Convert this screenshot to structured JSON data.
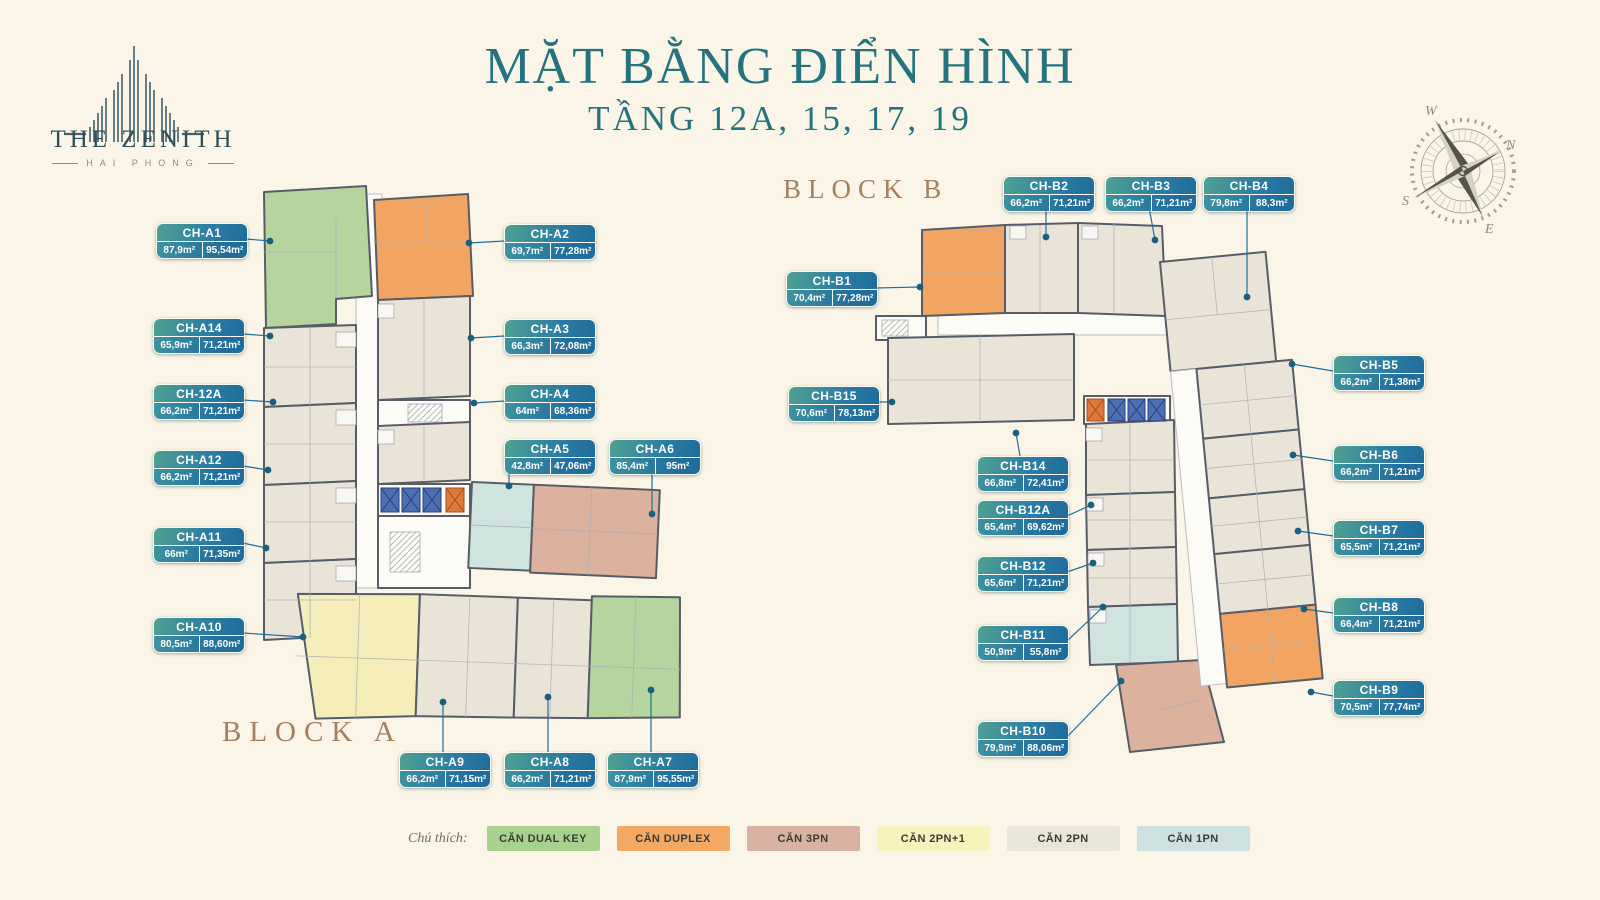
{
  "logo": {
    "name": "THE ZENITH",
    "sub": "HAI PHONG"
  },
  "title": {
    "line1": "MẶT BẰNG ĐIỂN HÌNH",
    "line2": "TẦNG 12A, 15, 17, 19"
  },
  "block_a": {
    "label": "BLOCK A"
  },
  "block_b": {
    "label": "BLOCK B"
  },
  "compass": {
    "n": "N",
    "e": "E",
    "s": "S",
    "w": "W"
  },
  "legend": {
    "label": "Chú thích:",
    "items": [
      {
        "label": "CĂN DUAL KEY",
        "color": "#a9d18e"
      },
      {
        "label": "CĂN DUPLEX",
        "color": "#f3a963"
      },
      {
        "label": "CĂN 3PN",
        "color": "#d9b2a4"
      },
      {
        "label": "CĂN 2PN+1",
        "color": "#f8f2bd"
      },
      {
        "label": "CĂN 2PN",
        "color": "#e9e5da"
      },
      {
        "label": "CĂN 1PN",
        "color": "#cde2e0"
      }
    ]
  },
  "badges": [
    {
      "id": "CH-A1",
      "a1": "87,9m²",
      "a2": "95,54m²",
      "type": "DUAL KEY",
      "x": 156,
      "y": 223,
      "line": [
        246,
        239,
        270,
        241
      ]
    },
    {
      "id": "CH-A14",
      "a1": "65,9m²",
      "a2": "71,21m²",
      "type": "2PN",
      "x": 153,
      "y": 318,
      "line": [
        243,
        334,
        270,
        336
      ]
    },
    {
      "id": "CH-12A",
      "a1": "66,2m²",
      "a2": "71,21m²",
      "type": "2PN",
      "x": 153,
      "y": 384,
      "line": [
        243,
        400,
        273,
        402
      ]
    },
    {
      "id": "CH-A12",
      "a1": "66,2m²",
      "a2": "71,21m²",
      "type": "2PN",
      "x": 153,
      "y": 450,
      "line": [
        243,
        466,
        268,
        470
      ]
    },
    {
      "id": "CH-A11",
      "a1": "66m²",
      "a2": "71,35m²",
      "type": "2PN",
      "x": 153,
      "y": 527,
      "line": [
        243,
        543,
        266,
        548
      ]
    },
    {
      "id": "CH-A10",
      "a1": "80,5m²",
      "a2": "88,60m²",
      "type": "2PN+1",
      "x": 153,
      "y": 617,
      "line": [
        243,
        633,
        303,
        637
      ]
    },
    {
      "id": "CH-A9",
      "a1": "66,2m²",
      "a2": "71,15m²",
      "type": "2PN",
      "x": 399,
      "y": 752,
      "line": [
        443,
        752,
        443,
        702
      ]
    },
    {
      "id": "CH-A8",
      "a1": "66,2m²",
      "a2": "71,21m²",
      "type": "2PN",
      "x": 504,
      "y": 752,
      "line": [
        548,
        752,
        548,
        697
      ]
    },
    {
      "id": "CH-A7",
      "a1": "87,9m²",
      "a2": "95,55m²",
      "type": "DUAL KEY",
      "x": 607,
      "y": 752,
      "line": [
        651,
        752,
        651,
        690
      ]
    },
    {
      "id": "CH-A2",
      "a1": "69,7m²",
      "a2": "77,28m²",
      "type": "DUPLEX",
      "x": 504,
      "y": 224,
      "line": [
        504,
        241,
        469,
        243
      ]
    },
    {
      "id": "CH-A3",
      "a1": "66,3m²",
      "a2": "72,08m²",
      "type": "2PN",
      "x": 504,
      "y": 319,
      "line": [
        504,
        336,
        471,
        338
      ]
    },
    {
      "id": "CH-A4",
      "a1": "64m²",
      "a2": "68,36m²",
      "type": "2PN",
      "x": 504,
      "y": 384,
      "line": [
        504,
        401,
        474,
        403
      ]
    },
    {
      "id": "CH-A5",
      "a1": "42,8m²",
      "a2": "47,06m²",
      "type": "1PN",
      "x": 504,
      "y": 439,
      "line": [
        509,
        470,
        509,
        486
      ]
    },
    {
      "id": "CH-A6",
      "a1": "85,4m²",
      "a2": "95m²",
      "type": "3PN",
      "x": 609,
      "y": 439,
      "line": [
        652,
        470,
        652,
        514
      ]
    },
    {
      "id": "CH-B1",
      "a1": "70,4m²",
      "a2": "77,28m²",
      "type": "DUPLEX",
      "x": 786,
      "y": 271,
      "line": [
        876,
        288,
        920,
        287
      ]
    },
    {
      "id": "CH-B2",
      "a1": "66,2m²",
      "a2": "71,21m²",
      "type": "2PN",
      "x": 1003,
      "y": 176,
      "line": [
        1046,
        207,
        1046,
        237
      ]
    },
    {
      "id": "CH-B3",
      "a1": "66,2m²",
      "a2": "71,21m²",
      "type": "2PN",
      "x": 1105,
      "y": 176,
      "line": [
        1149,
        207,
        1155,
        240
      ]
    },
    {
      "id": "CH-B4",
      "a1": "79,8m²",
      "a2": "88,3m²",
      "type": "2PN",
      "x": 1203,
      "y": 176,
      "line": [
        1247,
        207,
        1247,
        297
      ]
    },
    {
      "id": "CH-B15",
      "a1": "70,6m²",
      "a2": "78,13m²",
      "type": "2PN",
      "x": 788,
      "y": 386,
      "line": [
        878,
        402,
        892,
        402
      ]
    },
    {
      "id": "CH-B14",
      "a1": "66,8m²",
      "a2": "72,41m²",
      "type": "2PN",
      "x": 977,
      "y": 456,
      "line": [
        1020,
        456,
        1016,
        433
      ]
    },
    {
      "id": "CH-B12A",
      "a1": "65,4m²",
      "a2": "69,62m²",
      "type": "2PN",
      "x": 977,
      "y": 500,
      "line": [
        1067,
        516,
        1091,
        505
      ]
    },
    {
      "id": "CH-B12",
      "a1": "65,6m²",
      "a2": "71,21m²",
      "type": "2PN",
      "x": 977,
      "y": 556,
      "line": [
        1067,
        572,
        1093,
        563
      ]
    },
    {
      "id": "CH-B11",
      "a1": "50,9m²",
      "a2": "55,8m²",
      "type": "1PN",
      "x": 977,
      "y": 625,
      "line": [
        1067,
        641,
        1103,
        607
      ]
    },
    {
      "id": "CH-B10",
      "a1": "79,9m²",
      "a2": "88,06m²",
      "type": "3PN",
      "x": 977,
      "y": 721,
      "line": [
        1067,
        737,
        1121,
        681
      ]
    },
    {
      "id": "CH-B5",
      "a1": "66,2m²",
      "a2": "71,38m²",
      "type": "2PN",
      "x": 1333,
      "y": 355,
      "line": [
        1333,
        371,
        1292,
        364
      ]
    },
    {
      "id": "CH-B6",
      "a1": "66,2m²",
      "a2": "71,21m²",
      "type": "2PN",
      "x": 1333,
      "y": 445,
      "line": [
        1333,
        461,
        1293,
        455
      ]
    },
    {
      "id": "CH-B7",
      "a1": "65,5m²",
      "a2": "71,21m²",
      "type": "2PN",
      "x": 1333,
      "y": 520,
      "line": [
        1333,
        536,
        1298,
        531
      ]
    },
    {
      "id": "CH-B8",
      "a1": "66,4m²",
      "a2": "71,21m²",
      "type": "2PN",
      "x": 1333,
      "y": 597,
      "line": [
        1333,
        613,
        1304,
        609
      ]
    },
    {
      "id": "CH-B9",
      "a1": "70,5m²",
      "a2": "77,74m²",
      "type": "DUPLEX",
      "x": 1333,
      "y": 680,
      "line": [
        1333,
        696,
        1311,
        692
      ]
    }
  ]
}
